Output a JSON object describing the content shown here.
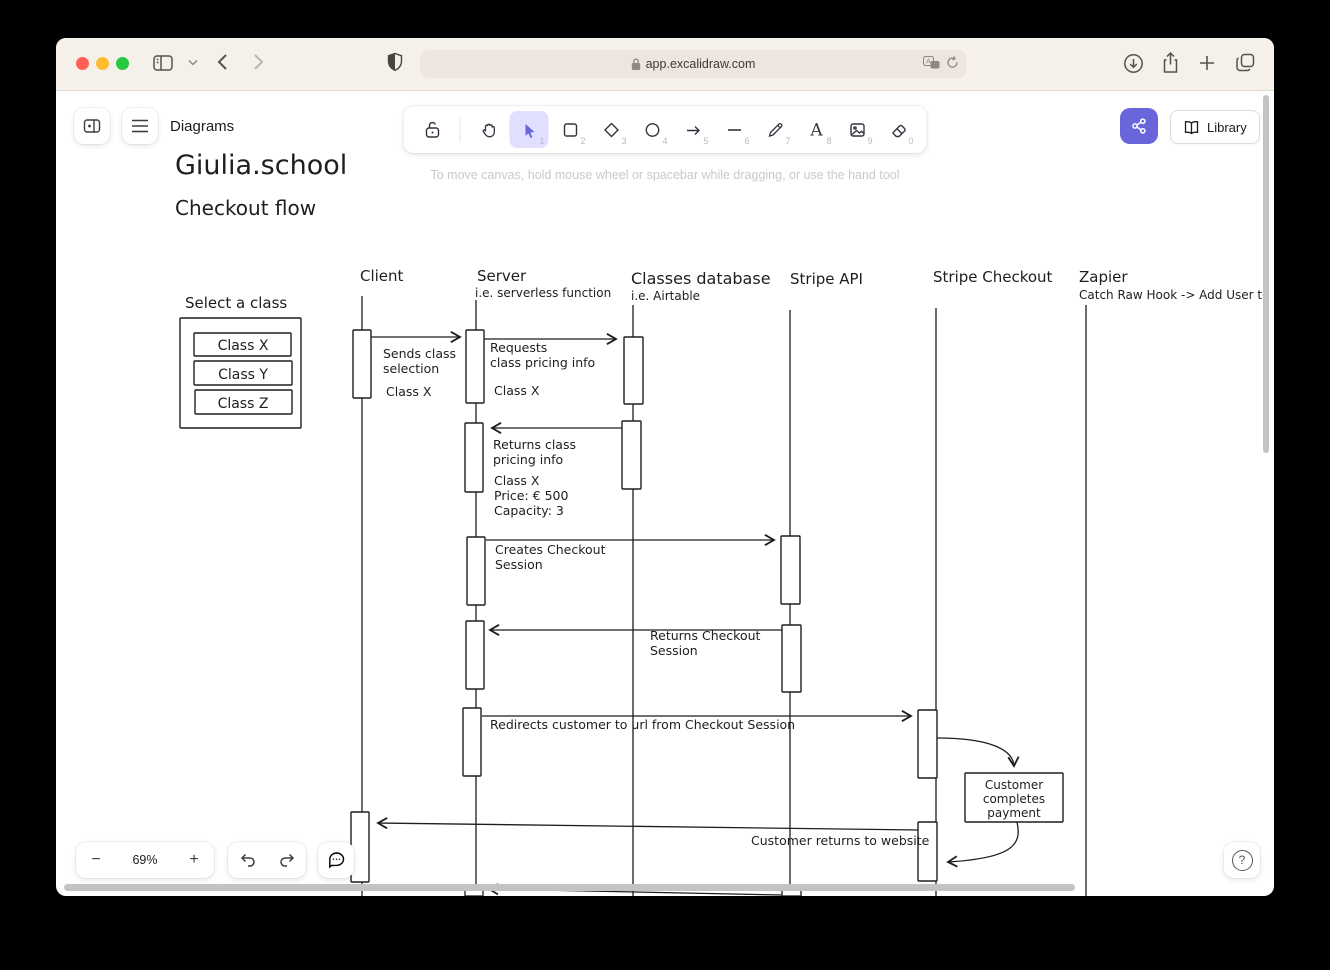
{
  "browser": {
    "url_host": "app.excalidraw.com",
    "traffic_lights": {
      "red": "#ff5f57",
      "yellow": "#febc2e",
      "green": "#28c840"
    }
  },
  "excalidraw": {
    "nav_title": "Diagrams",
    "canvas_hint": "To move canvas, hold mouse wheel or spacebar while dragging, or use the hand tool",
    "library_label": "Library",
    "zoom_level": "69%",
    "zoom_out_label": "−",
    "zoom_in_label": "+",
    "help_label": "?",
    "accent_color": "#6965db",
    "active_tool_bg": "#e0dfff",
    "tools": [
      {
        "name": "lock",
        "shortcut": ""
      },
      {
        "name": "hand",
        "shortcut": ""
      },
      {
        "name": "selection",
        "shortcut": "1"
      },
      {
        "name": "rectangle",
        "shortcut": "2"
      },
      {
        "name": "diamond",
        "shortcut": "3"
      },
      {
        "name": "ellipse",
        "shortcut": "4"
      },
      {
        "name": "arrow",
        "shortcut": "5"
      },
      {
        "name": "line",
        "shortcut": "6"
      },
      {
        "name": "draw",
        "shortcut": "7"
      },
      {
        "name": "text",
        "shortcut": "8"
      },
      {
        "name": "image",
        "shortcut": "9"
      },
      {
        "name": "eraser",
        "shortcut": "0"
      }
    ]
  },
  "diagram": {
    "title": "Giulia.school",
    "subtitle": "Checkout flow",
    "stroke_color": "#1e1e1e",
    "select_panel": {
      "heading": "Select a class",
      "options": [
        "Class X",
        "Class Y",
        "Class Z"
      ]
    },
    "actors": [
      {
        "name": "Client",
        "subtitle": ""
      },
      {
        "name": "Server",
        "subtitle": "i.e. serverless function"
      },
      {
        "name": "Classes database",
        "subtitle": "i.e. Airtable"
      },
      {
        "name": "Stripe API",
        "subtitle": ""
      },
      {
        "name": "Stripe Checkout",
        "subtitle": ""
      },
      {
        "name": "Zapier",
        "subtitle": "Catch Raw Hook -> Add User to Ex"
      }
    ],
    "messages": [
      {
        "from": "Client",
        "to": "Server",
        "label_lines": [
          "Sends class",
          "selection"
        ],
        "payload_lines": [
          "Class X"
        ]
      },
      {
        "from": "Server",
        "to": "Classes database",
        "label_lines": [
          "Requests",
          "class pricing info"
        ],
        "payload_lines": [
          "Class X"
        ]
      },
      {
        "from": "Classes database",
        "to": "Server",
        "label_lines": [
          "Returns class",
          "pricing info"
        ],
        "payload_lines": [
          "Class X",
          "Price: € 500",
          "Capacity: 3"
        ]
      },
      {
        "from": "Server",
        "to": "Stripe API",
        "label_lines": [
          "Creates Checkout",
          "Session"
        ],
        "payload_lines": []
      },
      {
        "from": "Stripe API",
        "to": "Server",
        "label_lines": [
          "Returns Checkout",
          "Session"
        ],
        "payload_lines": []
      },
      {
        "from": "Server",
        "to": "Stripe Checkout",
        "label_lines": [
          "Redirects customer to url from Checkout Session"
        ],
        "payload_lines": []
      },
      {
        "from": "Stripe Checkout",
        "to": "Client",
        "label_lines": [
          "Customer returns to website"
        ],
        "payload_lines": []
      }
    ],
    "note": {
      "lines": [
        "Customer",
        "completes",
        "payment"
      ]
    }
  }
}
